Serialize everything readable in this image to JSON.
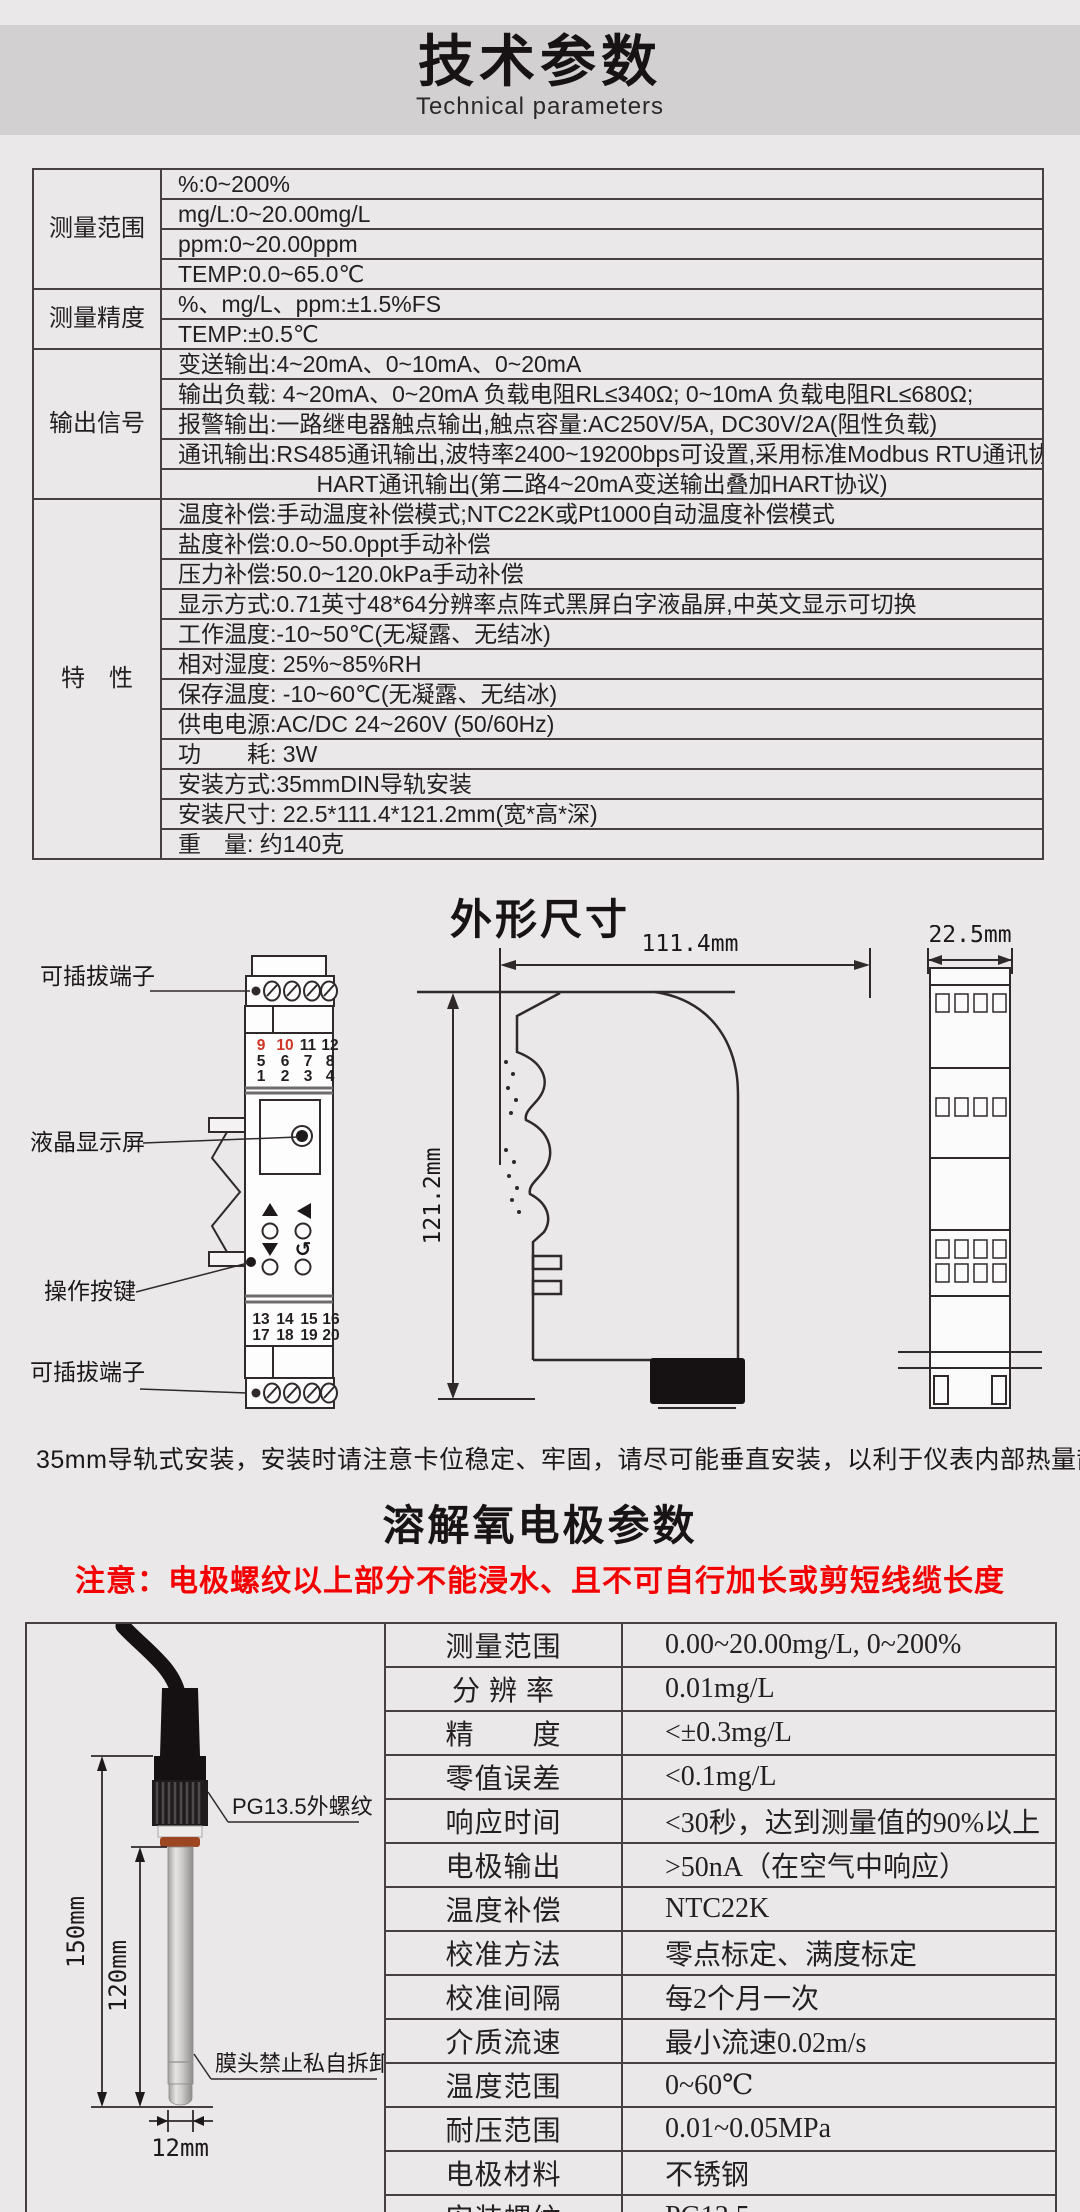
{
  "colors": {
    "page_bg": "#eae8e9",
    "banner_bg": "#d2d0d1",
    "table_line": "#473f40",
    "warning_red": "#f50000",
    "terminal_red": "#cf3526"
  },
  "header": {
    "title": "技术参数",
    "subtitle": "Technical parameters"
  },
  "spec_table": {
    "groups": [
      {
        "label": "测量范围",
        "rows": [
          "%:0~200%",
          "mg/L:0~20.00mg/L",
          "ppm:0~20.00ppm",
          "TEMP:0.0~65.0℃"
        ]
      },
      {
        "label": "测量精度",
        "rows": [
          "%、mg/L、ppm:±1.5%FS",
          "TEMP:±0.5℃"
        ]
      },
      {
        "label": "输出信号",
        "rows": [
          "变送输出:4~20mA、0~10mA、0~20mA",
          "输出负载: 4~20mA、0~20mA 负载电阻RL≤340Ω; 0~10mA 负载电阻RL≤680Ω;",
          "报警输出:一路继电器触点输出,触点容量:AC250V/5A, DC30V/2A(阻性负载)",
          "通讯输出:RS485通讯输出,波特率2400~19200bps可设置,采用标准Modbus RTU通讯协议",
          "HART通讯输出(第二路4~20mA变送输出叠加HART协议)"
        ]
      },
      {
        "label": "特　性",
        "rows": [
          "温度补偿:手动温度补偿模式;NTC22K或Pt1000自动温度补偿模式",
          "盐度补偿:0.0~50.0ppt手动补偿",
          "压力补偿:50.0~120.0kPa手动补偿",
          "显示方式:0.71英寸48*64分辨率点阵式黑屏白字液晶屏,中英文显示可切换",
          "工作温度:-10~50℃(无凝露、无结冰)",
          "相对湿度: 25%~85%RH",
          "保存温度: -10~60℃(无凝露、无结冰)",
          "供电电源:AC/DC 24~260V (50/60Hz)",
          "功　　耗: 3W",
          "安装方式:35mmDIN导轨安装",
          "安装尺寸: 22.5*111.4*121.2mm(宽*高*深)",
          "重　量: 约140克"
        ]
      }
    ]
  },
  "outline": {
    "title": "外形尺寸",
    "labels": {
      "plug_top": "可插拔端子",
      "lcd": "液晶显示屏",
      "keys": "操作按键",
      "plug_bottom": "可插拔端子"
    },
    "dims": {
      "width": "111.4mm",
      "height": "121.2mm",
      "depth": "22.5mm"
    },
    "terminals": {
      "top": [
        [
          "9",
          "10",
          "11",
          "12"
        ],
        [
          "5",
          "6",
          "7",
          "8"
        ],
        [
          "1",
          "2",
          "3",
          "4"
        ]
      ],
      "bottom": [
        [
          "13",
          "14",
          "15",
          "16"
        ],
        [
          "17",
          "18",
          "19",
          "20"
        ]
      ]
    }
  },
  "mount_note": "35mm导轨式安装，安装时请注意卡位稳定、牢固，请尽可能垂直安装，以利于仪表内部热量散发。",
  "electrode": {
    "title": "溶解氧电极参数",
    "warning": "注意：电极螺纹以上部分不能浸水、且不可自行加长或剪短线缆长度",
    "drawing": {
      "thread_label": "PG13.5外螺纹",
      "membrane_label": "膜头禁止私自拆卸",
      "dim_total": "150mm",
      "dim_body": "120mm",
      "dim_diameter": "12mm"
    },
    "params": [
      {
        "name": "测量范围",
        "value": "0.00~20.00mg/L, 0~200%"
      },
      {
        "name": "分 辨 率",
        "value": "0.01mg/L"
      },
      {
        "name": "精　　度",
        "value": "<±0.3mg/L"
      },
      {
        "name": "零值误差",
        "value": "<0.1mg/L"
      },
      {
        "name": "响应时间",
        "value": "<30秒，达到测量值的90%以上"
      },
      {
        "name": "电极输出",
        "value": ">50nA（在空气中响应）"
      },
      {
        "name": "温度补偿",
        "value": "NTC22K"
      },
      {
        "name": "校准方法",
        "value": "零点标定、满度标定"
      },
      {
        "name": "校准间隔",
        "value": "每2个月一次"
      },
      {
        "name": "介质流速",
        "value": "最小流速0.02m/s"
      },
      {
        "name": "温度范围",
        "value": "0~60℃"
      },
      {
        "name": "耐压范围",
        "value": "0.01~0.05MPa"
      },
      {
        "name": "电极材料",
        "value": "不锈钢"
      },
      {
        "name": "安装螺纹",
        "value": "PG13.5"
      },
      {
        "name": "电极尺寸",
        "value": "120mm*Φ12mm"
      }
    ]
  }
}
